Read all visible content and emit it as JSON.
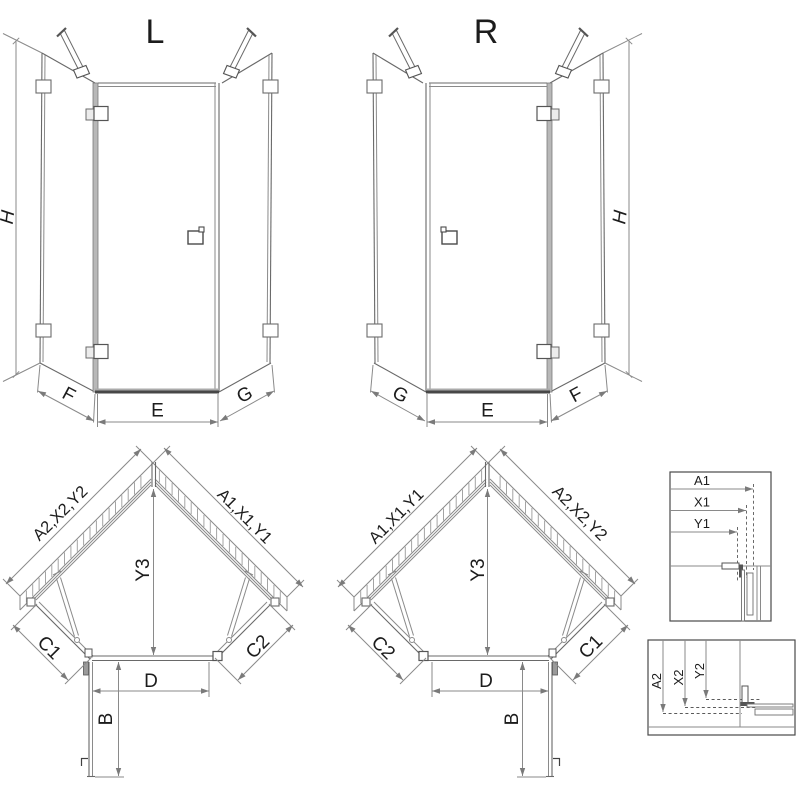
{
  "front_left": {
    "name": "L",
    "height": "H",
    "bottom_left": "F",
    "bottom_center": "E",
    "bottom_right": "G"
  },
  "front_right": {
    "name": "R",
    "height": "H",
    "bottom_left": "G",
    "bottom_center": "E",
    "bottom_right": "F"
  },
  "plan_left": {
    "wall_upper_left": "A2,X2,Y2",
    "wall_upper_right": "A1,X1,Y1",
    "center_depth": "Y3",
    "lower_left": "C1",
    "lower_right": "C2",
    "door_width": "D",
    "door_open_depth": "B"
  },
  "plan_right": {
    "wall_upper_left": "A1,X1,Y1",
    "wall_upper_right": "A2,X2,Y2",
    "center_depth": "Y3",
    "lower_left": "C2",
    "lower_right": "C1",
    "door_width": "D",
    "door_open_depth": "B"
  },
  "detail_upper": {
    "labels": [
      "A1",
      "X1",
      "Y1"
    ]
  },
  "detail_lower": {
    "labels": [
      "A2",
      "X2",
      "Y2"
    ]
  },
  "colors": {
    "line": "#8a8a8a",
    "edge": "#696969",
    "dark": "#404040",
    "text": "#1c1c1c",
    "background": "#ffffff"
  }
}
